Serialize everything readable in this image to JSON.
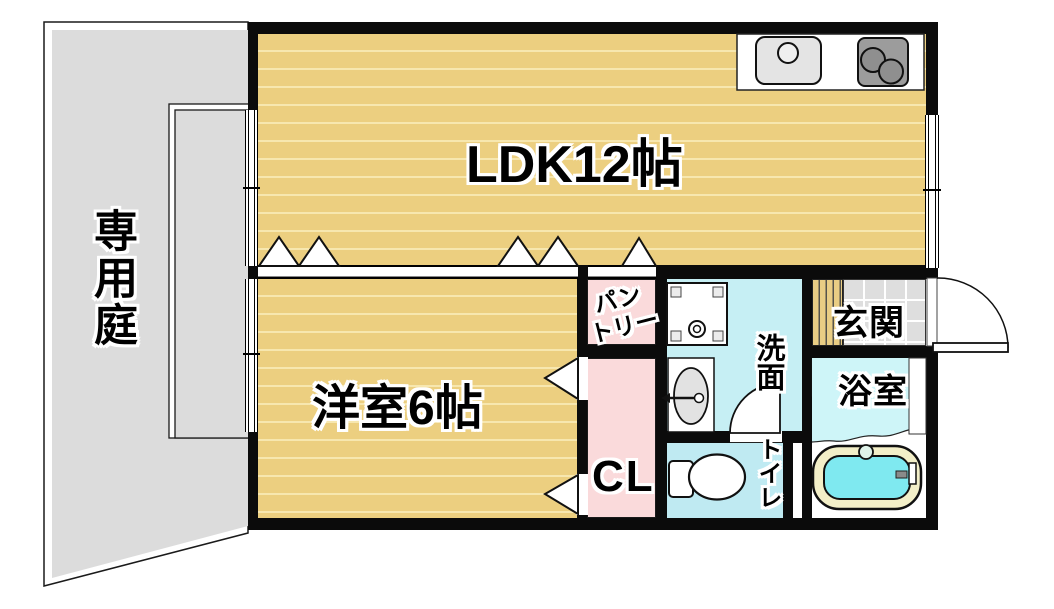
{
  "document": {
    "type": "japanese-apartment-floor-plan"
  },
  "rooms": {
    "private_garden": {
      "label": "専用庭"
    },
    "ldk": {
      "label": "LDK12帖"
    },
    "western_room": {
      "label": "洋室6帖"
    },
    "pantry": {
      "line1": "パン",
      "line2": "トリー"
    },
    "closet": {
      "label": "CL"
    },
    "washroom": {
      "label": "洗面"
    },
    "toilet": {
      "label": "トイレ"
    },
    "entrance": {
      "label": "玄関"
    },
    "bathroom": {
      "label": "浴室"
    }
  },
  "colors": {
    "wall_black": "#0B0B0B",
    "tatami_base": "#ECCF80",
    "tatami_line": "#F7E7AF",
    "garden_gray": "#DCDCDC",
    "room_pink": "#FADADB",
    "wet_area_cyan": "#C6EFF4",
    "toilet_cyan": "#BFEAF2",
    "bath_floor_cyan": "#CEF5F8",
    "tub_water_cyan": "#7FE9F0",
    "tub_rim_cream": "#F3EFC8",
    "stove_gray": "#9C9C9C",
    "entrance_tile_gray": "#DEDEDE",
    "entrance_step_wood": "#E9CD84"
  },
  "icons": {
    "kitchen_sink": "sink-icon",
    "kitchen_stove": "stove-icon",
    "washing_machine_pan": "washing-machine-icon",
    "washbasin": "washbasin-icon",
    "toilet_bowl": "toilet-icon",
    "bathtub": "bathtub-icon",
    "door_swings": "door-arc-icon",
    "folding_door_marks": "door-triangle-icon"
  }
}
